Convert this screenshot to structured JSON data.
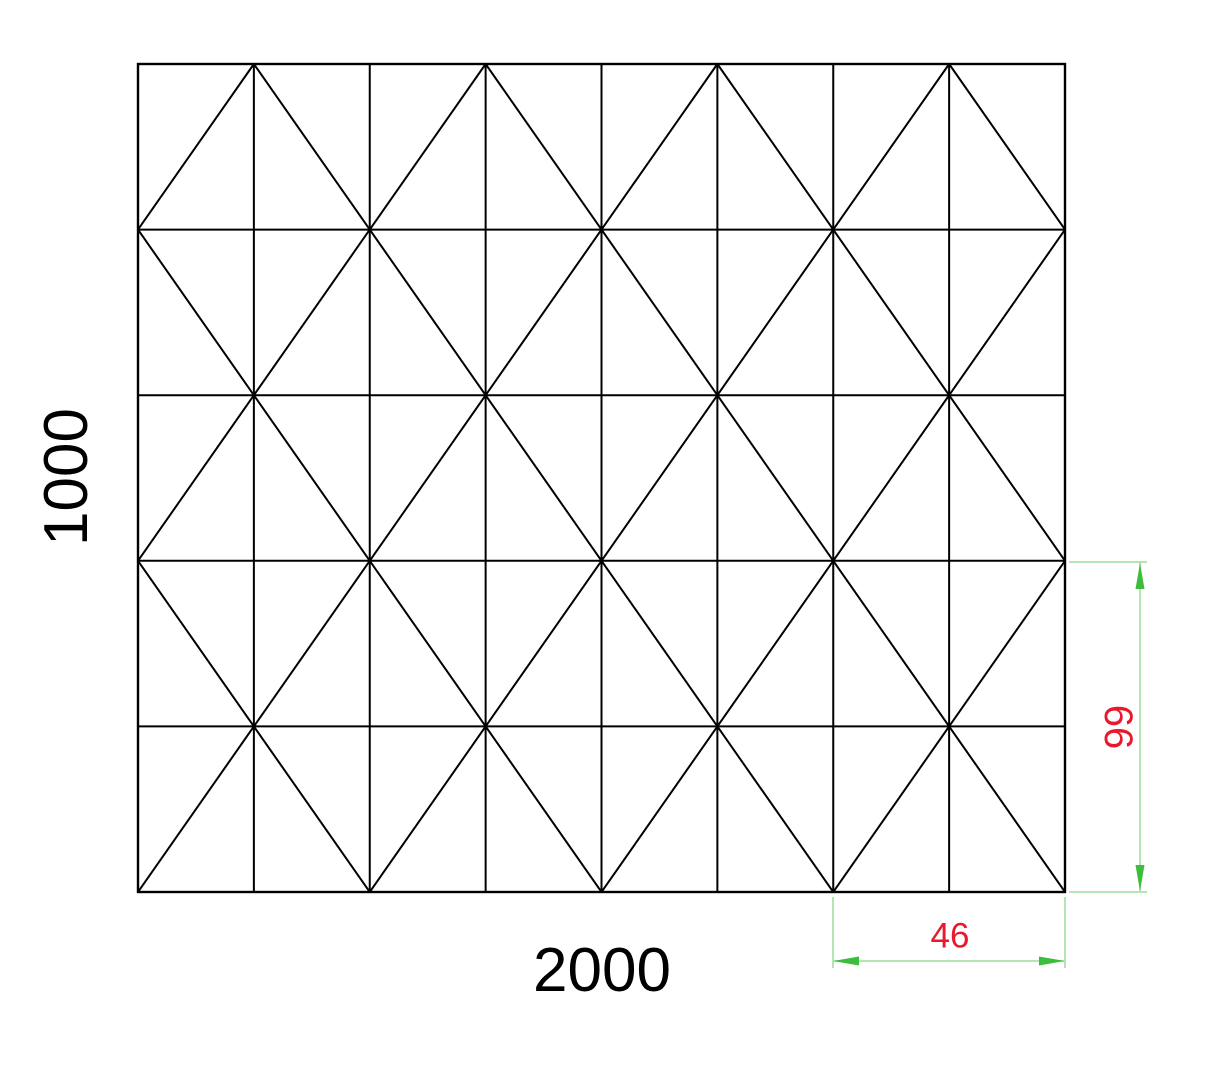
{
  "drawing": {
    "background": "#ffffff",
    "panel_outline": {
      "x": 138,
      "y": 64,
      "width": 927,
      "height": 828,
      "stroke": "#000000",
      "stroke_width": 2
    },
    "mesh": {
      "columns": 8,
      "rows": 5,
      "pattern": "2x2-diagonal-cross",
      "description": "8x5 rectangular grid with X diagonals in 2-column by 2-row blocks, offset half a block vertically so half-diamonds peak at the top edge"
    },
    "labels": {
      "overall_width": {
        "text": "2000",
        "value": 2000,
        "color": "#000000",
        "font_size": 62,
        "cx": 602,
        "cy": 971,
        "rotation": 0
      },
      "overall_height": {
        "text": "1000",
        "value": 1000,
        "color": "#000000",
        "font_size": 62,
        "cx": 67,
        "cy": 477,
        "rotation": -90
      }
    },
    "dimensions": {
      "line_color": "#9ade9a",
      "arrow_color": "#3cbe3c",
      "text_color": "#e8192c",
      "vertical": {
        "text": "66",
        "value": 66,
        "font_size": 40,
        "dim_x": 1140,
        "from_y": 562,
        "to_y": 891,
        "ext_x_from": 1069,
        "ext_x_to": 1147,
        "label_cx": 1118,
        "label_cy": 727,
        "label_rotation": 90
      },
      "horizontal": {
        "text": "46",
        "value": 46,
        "font_size": 35,
        "dim_y": 961,
        "from_x": 834,
        "to_x": 1064,
        "ext_y_from": 897,
        "ext_y_to": 968,
        "label_cx": 950,
        "label_cy": 936,
        "label_rotation": 0
      }
    }
  }
}
